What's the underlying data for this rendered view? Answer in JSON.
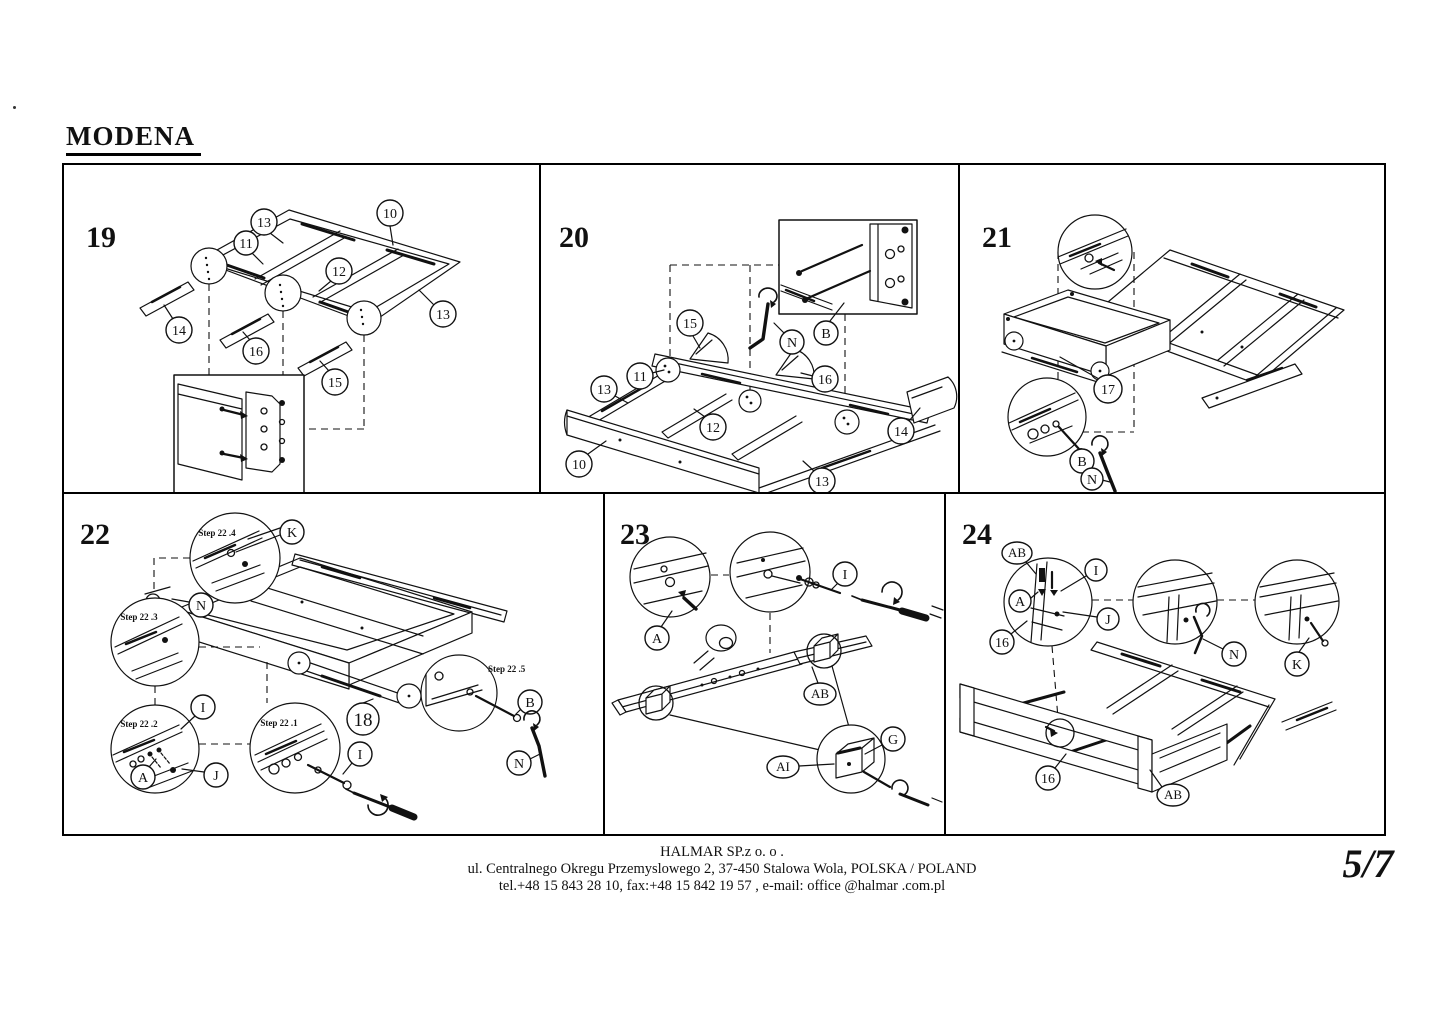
{
  "header": {
    "title": "MODENA"
  },
  "page_number": "5/7",
  "footer": {
    "company": "HALMAR SP.z o. o .",
    "address": "ul. Centralnego Okregu Przemyslowego 2, 37-450 Stalowa Wola, POLSKA / POLAND",
    "contact": "tel.+48 15 843 28 10, fax:+48 15 842 19 57 , e-mail: office @halmar .com.pl"
  },
  "icons": {
    "allen_key": "L-shaped hex key",
    "screwdriver": "screwdriver with rotation arrow",
    "magnifier": "detail zoom circle",
    "detail_inset": "detail zoom box"
  },
  "panels": {
    "p19": {
      "step": "19",
      "callouts": [
        "13",
        "10",
        "11",
        "12",
        "13",
        "14",
        "16",
        "15"
      ]
    },
    "p20": {
      "step": "20",
      "callouts": [
        "15",
        "11",
        "13",
        "12",
        "10",
        "13",
        "16",
        "14",
        "B",
        "N"
      ]
    },
    "p21": {
      "step": "21",
      "callouts": [
        "17",
        "B",
        "N"
      ]
    },
    "p22": {
      "step": "22",
      "substeps": [
        "Step 22 .4",
        "Step 22 .3",
        "Step 22 .2",
        "Step 22 .1",
        "Step 22 .5"
      ],
      "callouts": [
        "K",
        "N",
        "I",
        "A",
        "J",
        "I",
        "18",
        "B",
        "N"
      ]
    },
    "p23": {
      "step": "23",
      "callouts": [
        "A",
        "I",
        "AB",
        "AI",
        "G"
      ]
    },
    "p24": {
      "step": "24",
      "callouts": [
        "AB",
        "I",
        "A",
        "J",
        "16",
        "N",
        "K",
        "16",
        "AB"
      ]
    }
  }
}
